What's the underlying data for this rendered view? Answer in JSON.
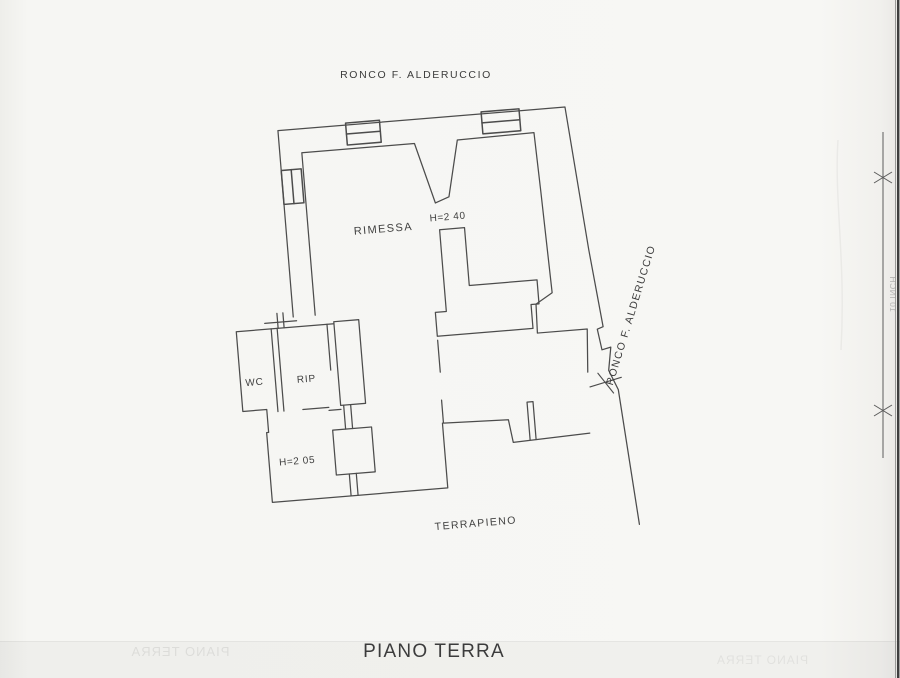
{
  "page": {
    "title": "PIANO TERRA",
    "paper_color": "#f6f6f3",
    "line_color": "#4c4c4c",
    "edge_color": "#3e3e3e"
  },
  "labels": {
    "street_top": "RONCO F. ALDERUCCIO",
    "street_right": "RONCO F. ALDERUCCIO",
    "terrain": "TERRAPIENO"
  },
  "rooms": {
    "main_name": "RIMESSA",
    "main_height_note": "H=2 40",
    "wc_name": "WC",
    "storage_name": "RIP",
    "lower_height_note": "H=2 05"
  },
  "side_marker": {
    "text": "10 INCH"
  },
  "ghost": {
    "left": "PIANO TERRA",
    "right": "PIANO TERRA"
  }
}
